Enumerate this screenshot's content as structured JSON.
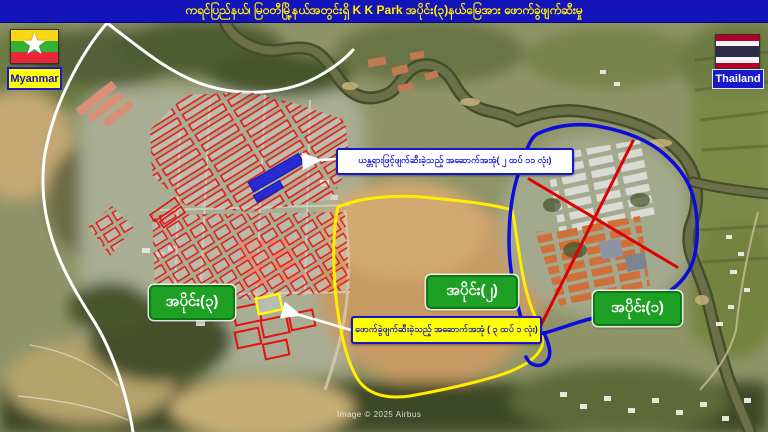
{
  "title_bar": {
    "text": "ကရင်ပြည်နယ်၊ မြဝတီမြို့နယ်အတွင်းရှိ K K Park အပိုင်း(၃)နယ်မြေအား ဖောက်ခွဲဖျက်ဆီးမှု"
  },
  "flags": {
    "myanmar": {
      "label": "Myanmar"
    },
    "thailand": {
      "label": "Thailand"
    }
  },
  "zone_labels": {
    "part1": "အပိုင်း(၁)",
    "part2": "အပိုင်း(၂)",
    "part3": "အပိုင်း(၃)"
  },
  "callouts": {
    "machine_demolished": {
      "text": "ယန္တရားဖြင့်ဖျက်ဆီးခဲ့သည့် အဆောက်အအုံ( ၂ ထပ် ၁၁ လုံး)"
    },
    "blast_demolished": {
      "text": "ဖောက်ခွဲဖျက်ဆီးခဲ့သည့် အဆောက်အအုံ ( ၃ ထပ် ၁ လုံး)"
    }
  },
  "watermark": "Image © 2025 Airbus",
  "colors": {
    "title_bar_bg": "#1414bb",
    "title_text": "#ffef00",
    "zone_label_bg": "#1da023",
    "part1_outline_blue": "#0b0bdd",
    "part2_outline_yellow": "#ffee00",
    "part3_building_outline_red": "#e81111",
    "red_cross": "#dd0000",
    "highlight_building_blue": "#2a2ad2",
    "highlight_building_yellow": "#ffff00",
    "callout_text": "#1515cc",
    "myanmar_label_bg": "#ffff00",
    "thailand_label_bg": "#1a1acc"
  }
}
